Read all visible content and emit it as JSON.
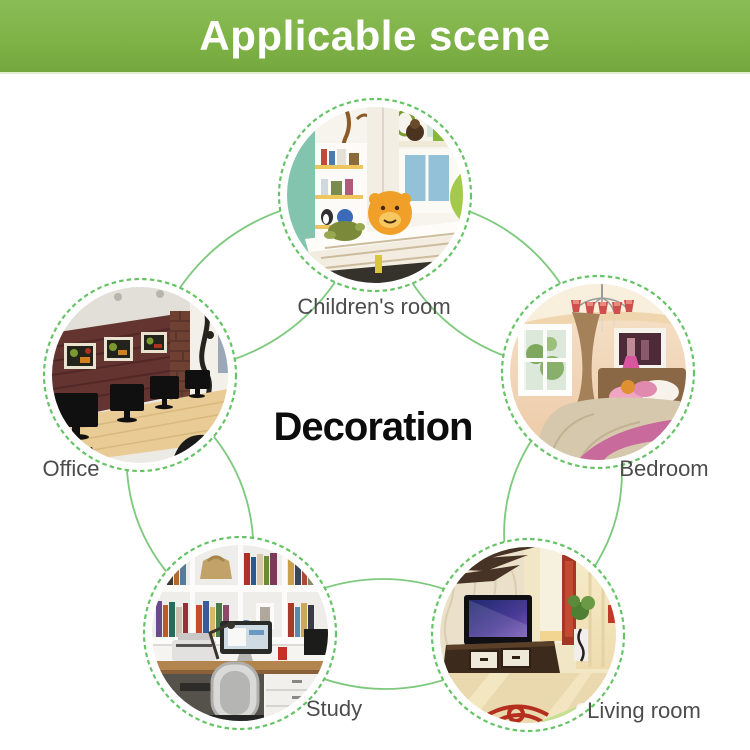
{
  "header": {
    "title": "Applicable scene"
  },
  "diagram": {
    "center_label": "Decoration",
    "scenes": [
      {
        "id": "childrens-room",
        "label": "Children's room"
      },
      {
        "id": "office",
        "label": "Office"
      },
      {
        "id": "bedroom",
        "label": "Bedroom"
      },
      {
        "id": "study",
        "label": "Study"
      },
      {
        "id": "living-room",
        "label": "Living room"
      }
    ]
  },
  "colors": {
    "banner_green": "#7fb348",
    "banner_text": "#ffffff",
    "ring_line_green": "#7ec97e",
    "dotted_circle_green": "#66c366",
    "label_gray": "#4c4c4c",
    "center_text": "#0c0c0c",
    "background": "#ffffff"
  }
}
